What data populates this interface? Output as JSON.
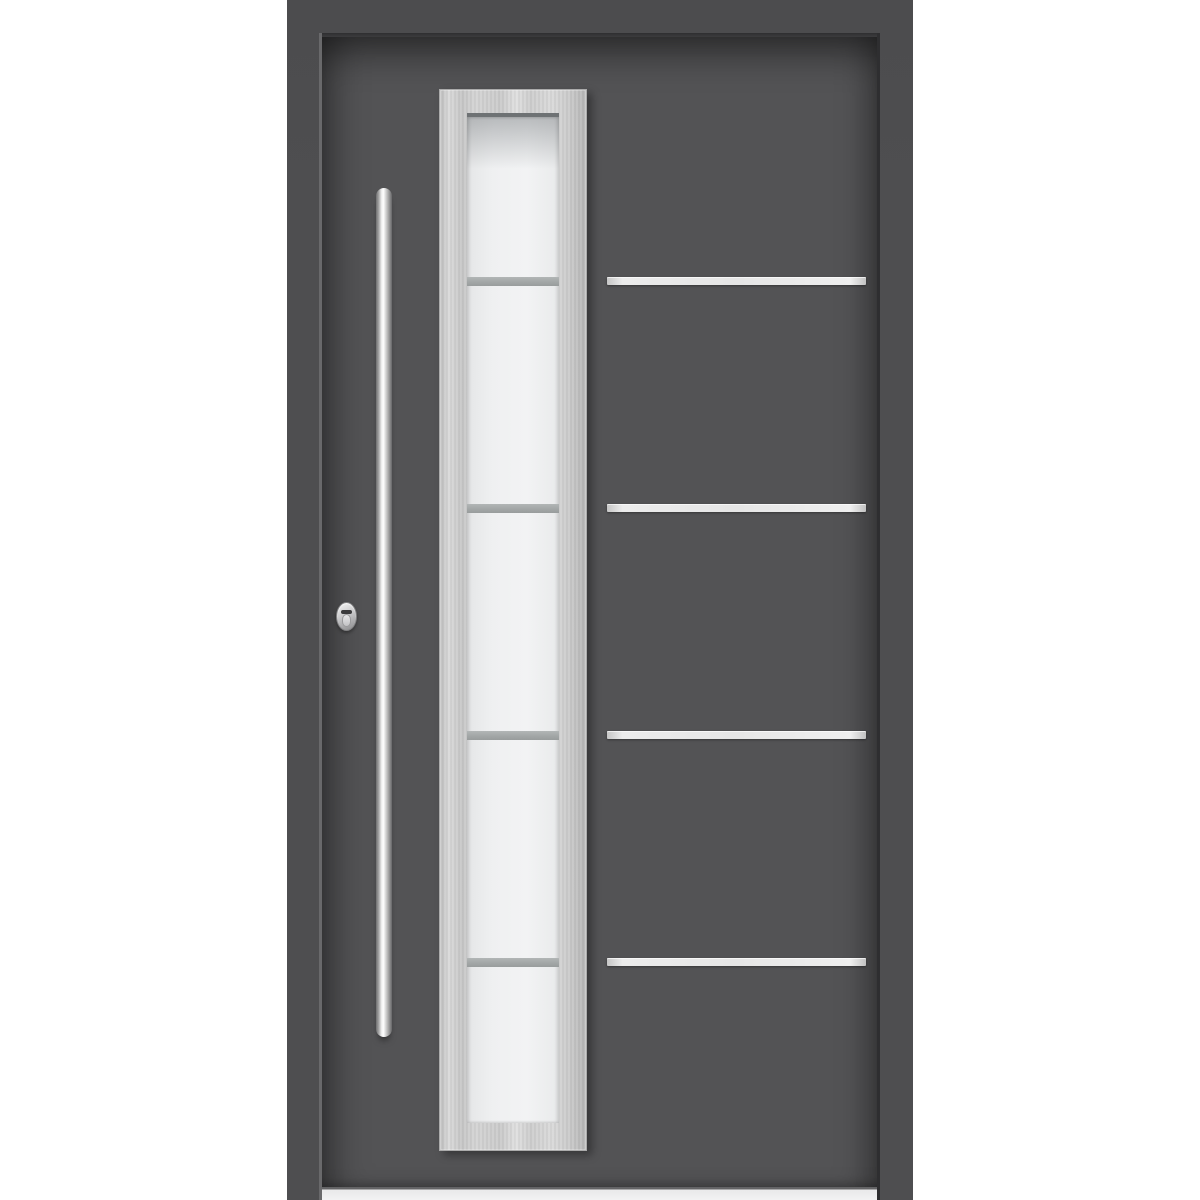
{
  "meta": {
    "type": "product-photo",
    "subject": "modern-aluminum-entry-door",
    "orientation": "front-view"
  },
  "scene": {
    "colors": {
      "page_bg": "#ffffff",
      "frame": "#4e4e50",
      "leaf": "#535355",
      "gap_light": "#69696b",
      "gap_dark": "#2e2e30",
      "steel_frame": "#cfcfcf",
      "glass": "#eff0f1",
      "glass_top_line": "#6e7274",
      "divider": "#a5a9a9",
      "stripe": "#e6e6e6",
      "handle_edge": "#6e6e70",
      "handle_core": "#ffffff",
      "threshold": "#e9e9ea",
      "lock_silver": "#c9c9cb"
    },
    "door": {
      "finish": "anthracite-gray",
      "has_frame": true,
      "threshold": "aluminum-sill"
    },
    "glazing": {
      "frame_finish": "brushed-stainless-steel",
      "glass_finish": "frosted-white",
      "pane_count": 5,
      "divider_count": 4
    },
    "inlays": {
      "stripe_count": 4,
      "finish": "stainless-steel",
      "y_positions": [
        277,
        504,
        731,
        958
      ]
    },
    "hardware": {
      "handle": {
        "type": "vertical-bar-pull",
        "finish": "stainless-steel"
      },
      "lock": {
        "type": "oval-escutcheon-cylinder",
        "finish": "stainless-steel"
      }
    }
  }
}
